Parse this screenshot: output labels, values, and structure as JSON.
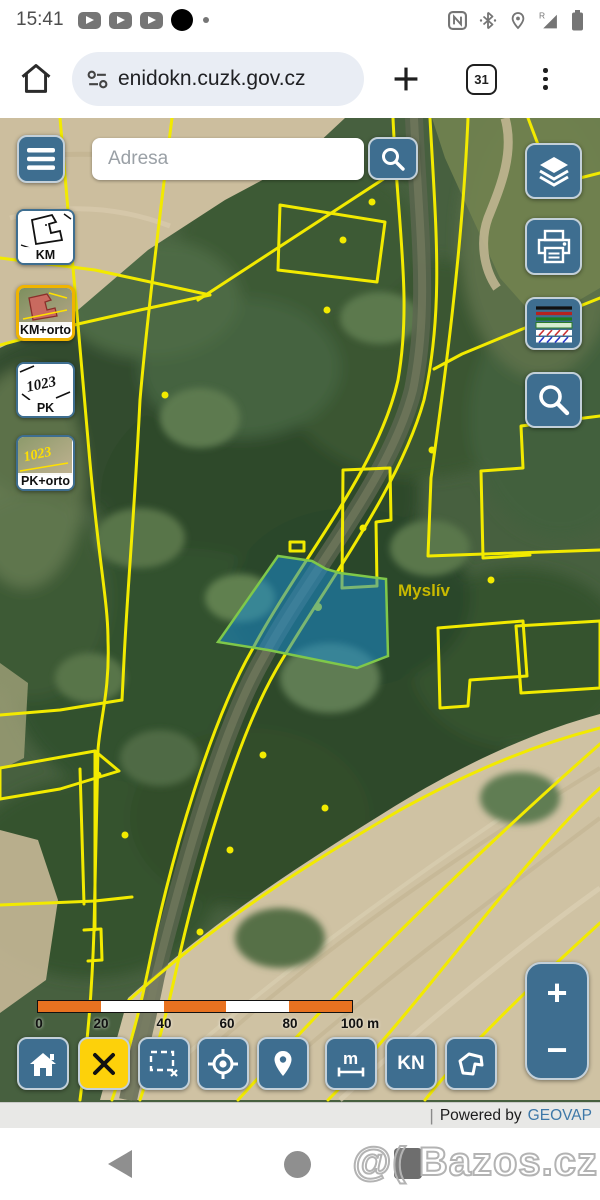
{
  "status_bar": {
    "time": "15:41"
  },
  "browser": {
    "url": "enidokn.cuzk.gov.cz",
    "tab_count": "31"
  },
  "map": {
    "search_placeholder": "Adresa",
    "layer_buttons": [
      {
        "label": "KM",
        "selected": false
      },
      {
        "label": "KM+orto",
        "selected": true
      },
      {
        "label": "PK",
        "selected": false
      },
      {
        "label": "PK+orto",
        "selected": false
      }
    ],
    "place_label": "Myslív",
    "scale_ticks": [
      "0",
      "20",
      "40",
      "60",
      "80",
      "100 m"
    ],
    "toolbar": {
      "measure_label": "m",
      "kn_label": "KN"
    },
    "zoom": {
      "plus": "+",
      "minus": "−"
    },
    "attribution": {
      "separator": "|",
      "powered_by": "Powered by",
      "vendor": "GEOVAP"
    }
  },
  "nav": {
    "watermark": "@( Bazos.cz"
  },
  "colors": {
    "button_blue": "#3e6e90",
    "selected_yellow": "#fdd10a",
    "cadastral_yellow": "#f2ea00",
    "parcel_highlight": "#1e8ad0",
    "link_blue": "#3e78a8",
    "scale_orange": "#e87220"
  }
}
